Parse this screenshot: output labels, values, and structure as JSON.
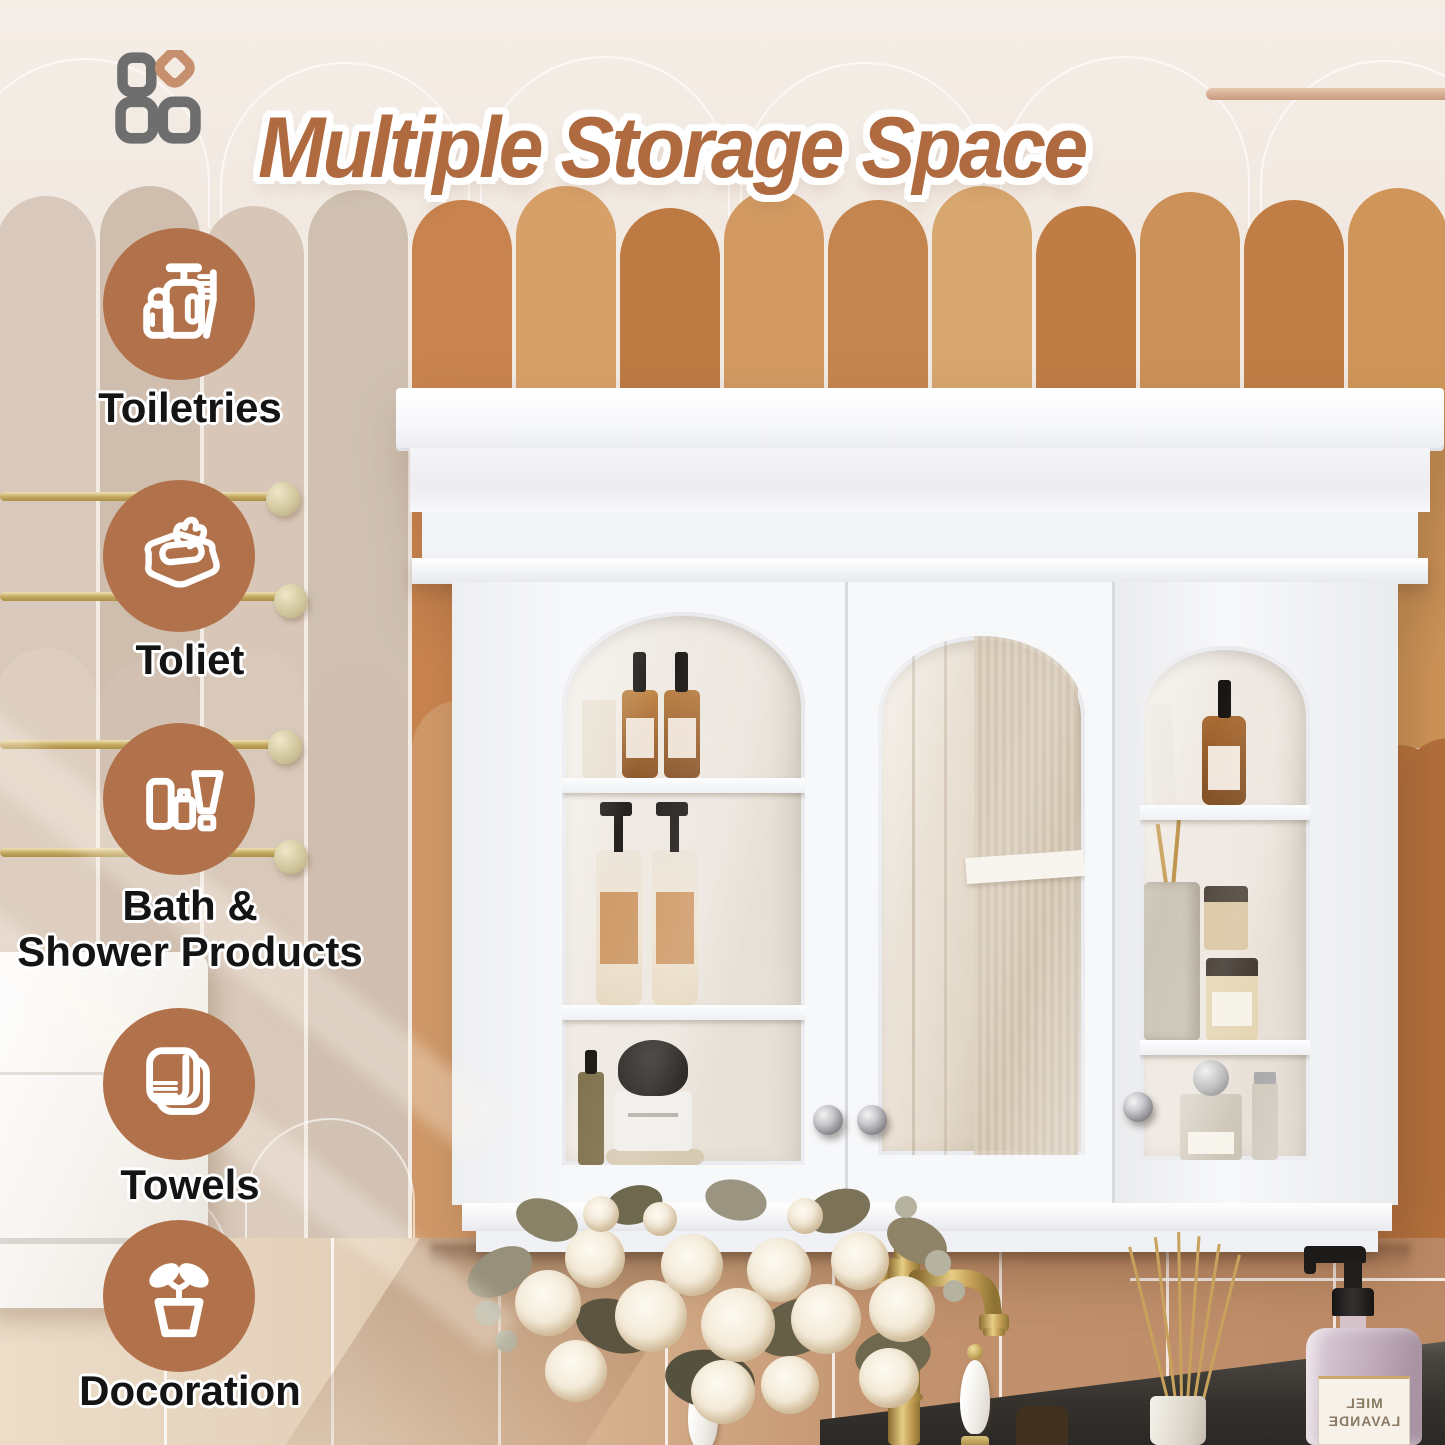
{
  "header": {
    "title": "Multiple Storage Space",
    "logo_icon": "four-squares-logo-icon"
  },
  "features": [
    {
      "icon": "toiletries-icon",
      "label": "Toiletries"
    },
    {
      "icon": "wet-wipes-icon",
      "label": "Toliet"
    },
    {
      "icon": "bath-shower-products-icon",
      "label_line1": "Bath &",
      "label_line2": "Shower Products"
    },
    {
      "icon": "towels-icon",
      "label": "Towels"
    },
    {
      "icon": "plant-pot-icon",
      "label": "Docoration"
    }
  ],
  "soap_bottle": {
    "label_line1": "MIEL",
    "label_line2": "LAVANDE",
    "note": "label seen mirrored"
  },
  "colors": {
    "title_text": "#b06a3f",
    "feature_circle": "#b1714a",
    "feature_label_text": "#141414",
    "wall_cream": "#f2ebe4",
    "tile_orange_palette": [
      "#c9834e",
      "#d7a068",
      "#bd7a43",
      "#d29a62",
      "#c5854f",
      "#d8a66f",
      "#bf7c45",
      "#cc9158",
      "#c07e46",
      "#d09659"
    ],
    "tile_pale_palette": [
      "#d9c9bc",
      "#cfbdae",
      "#d8c7b8",
      "#cfc0b1"
    ],
    "lower_wall_tan": "#c2926e",
    "counter_dark": "#35322e",
    "cabinet_white": "#f7f8fa",
    "faucet_gold": "#c3a055",
    "soap_bottle_lavender": "#c5b1c0"
  }
}
